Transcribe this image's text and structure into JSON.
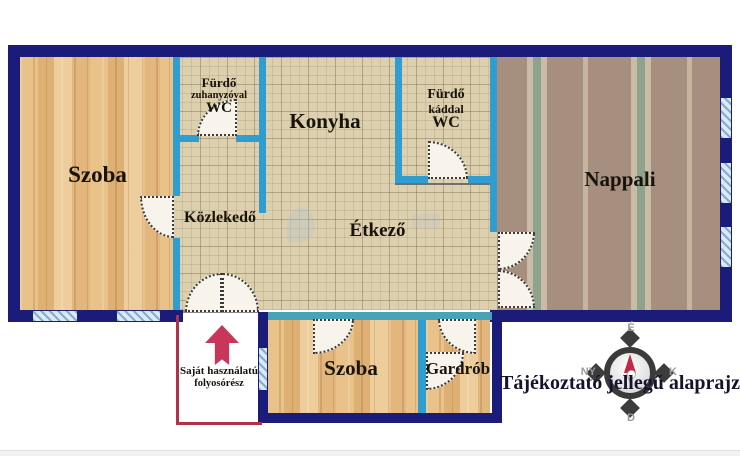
{
  "rooms": {
    "szoba_left": {
      "label": "Szoba"
    },
    "furdo_zuhanyzoval": {
      "line1": "Fürdő",
      "line2": "zuhanyzóval",
      "line3": "WC"
    },
    "konyha": {
      "label": "Konyha"
    },
    "furdo_kaddal": {
      "line1": "Fürdő",
      "line2": "káddal",
      "line3": "WC"
    },
    "nappali": {
      "label": "Nappali"
    },
    "kozlekedo": {
      "label": "Közlekedő"
    },
    "etkezo": {
      "label": "Étkező"
    },
    "szoba_bottom": {
      "label": "Szoba"
    },
    "gardrob": {
      "label": "Gardrób"
    },
    "folyoso": {
      "line1": "Saját használatú",
      "line2": "folyosórész"
    }
  },
  "compass": {
    "north": "É",
    "south": "D",
    "east": "K",
    "west": "NY"
  },
  "caption": {
    "text": "Tájékoztató jellegű alaprajz"
  },
  "colors": {
    "outer_wall": "#1b1b7a",
    "inner_wall": "#2f9dd0",
    "private_outline_red": "#b23048",
    "arrow_red": "#c8375a",
    "compass_needle": "#c22848"
  }
}
